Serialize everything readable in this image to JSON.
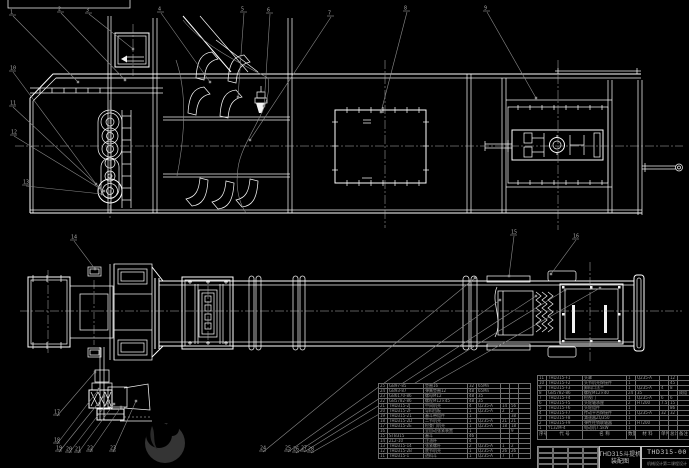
{
  "meta": {
    "drawing_type": "CAD assembly drawing, bucket elevator THD315",
    "bg_color": "#000000",
    "line_color": "#ffffff",
    "annotation_color": "#8a8a8a"
  },
  "title_block": {
    "title_line1": "THD315斗提机",
    "title_line2": "装配图",
    "drawing_number": "THD315-00",
    "organization": "机械设计第二课程设计"
  },
  "bom_header": [
    "序号",
    "代 号",
    "名 称",
    "数量",
    "材 料",
    "单件",
    "总计",
    "备注"
  ],
  "bom_left": {
    "rows": [
      {
        "no": "25",
        "code": "GB97-85",
        "name": "垫圈16",
        "qty": "32",
        "mat": "65Mn",
        "uw": "",
        "tw": "",
        "note": ""
      },
      {
        "no": "24",
        "code": "GB93-87",
        "name": "弹簧垫圈12",
        "qty": "48",
        "mat": "65Mn",
        "uw": "",
        "tw": "",
        "note": ""
      },
      {
        "no": "23",
        "code": "GB6170-86",
        "name": "螺母M12",
        "qty": "48",
        "mat": "35",
        "uw": "",
        "tw": "",
        "note": ""
      },
      {
        "no": "22",
        "code": "GB5782-86",
        "name": "螺栓M12×45",
        "qty": "48",
        "mat": "35",
        "uw": "",
        "tw": "",
        "note": ""
      },
      {
        "no": "21",
        "code": "THD315-2J",
        "name": "中间机壳",
        "qty": "4",
        "mat": "Q235-A",
        "uw": "14",
        "tw": "56",
        "note": ""
      },
      {
        "no": "20",
        "code": "THD315-2F",
        "name": "导料挡板",
        "qty": "1",
        "mat": "Q235-A",
        "uw": "2",
        "tw": "2",
        "note": ""
      },
      {
        "no": "19",
        "code": "THD315-21",
        "name": "畚斗带组件",
        "qty": "1",
        "mat": "",
        "uw": "",
        "tw": "38",
        "note": ""
      },
      {
        "no": "18",
        "code": "THD315-2D",
        "name": "二节机壳",
        "qty": "1",
        "mat": "Q235-A",
        "uw": "21",
        "tw": "21",
        "note": ""
      },
      {
        "no": "17",
        "code": "THD315-2E",
        "name": "检查门机壳",
        "qty": "1",
        "mat": "Q235-A",
        "uw": "18",
        "tw": "18",
        "note": ""
      },
      {
        "no": "16",
        "code": "",
        "name": "全自动张紧装置",
        "qty": "1",
        "mat": "",
        "uw": "",
        "tw": "9",
        "note": ""
      },
      {
        "no": "15",
        "code": "STB315",
        "name": "畚斗",
        "qty": "46",
        "mat": "",
        "uw": "",
        "tw": "",
        "note": ""
      },
      {
        "no": "14",
        "code": "ZL2-10",
        "name": "注油杯",
        "qty": "4",
        "mat": "",
        "uw": "",
        "tw": "",
        "note": ""
      },
      {
        "no": "13",
        "code": "THD315-14",
        "name": "张紧螺杆",
        "qty": "2",
        "mat": "Q235-A",
        "uw": "1",
        "tw": "2",
        "note": ""
      },
      {
        "no": "12",
        "code": "THD315-2B",
        "name": "底节机壳",
        "qty": "1",
        "mat": "Q235-A",
        "uw": "26",
        "tw": "26",
        "note": ""
      },
      {
        "no": "11",
        "code": "THD315-1",
        "name": "进料斗",
        "qty": "1",
        "mat": "Q235-A",
        "uw": "7",
        "tw": "7",
        "note": ""
      }
    ]
  },
  "bom_right": {
    "rows": [
      {
        "no": "11",
        "code": "THD315-F1",
        "name": "头罩",
        "qty": "1",
        "mat": "Q235-A",
        "uw": "",
        "tw": "12",
        "note": ""
      },
      {
        "no": "10",
        "code": "THD315-F2",
        "name": "头节机壳焊接件",
        "qty": "1",
        "mat": "",
        "uw": "",
        "tw": "45",
        "note": ""
      },
      {
        "no": "9",
        "code": "THD315-F3",
        "name": "卸料口法兰",
        "qty": "1",
        "mat": "Q235-A",
        "uw": "4",
        "tw": "8",
        "note": ""
      },
      {
        "no": "8",
        "code": "GB5782-86",
        "name": "螺栓M12×40",
        "qty": "24",
        "mat": "35",
        "uw": "",
        "tw": "",
        "note": "成组"
      },
      {
        "no": "7",
        "code": "THD315-F4",
        "name": "检视门",
        "qty": "1",
        "mat": "Q235-A",
        "uw": "6",
        "tw": "6",
        "note": ""
      },
      {
        "no": "6",
        "code": "THD315-F5",
        "name": "头轮轴承座",
        "qty": "2",
        "mat": "HT200",
        "uw": "7.5",
        "tw": "15",
        "note": ""
      },
      {
        "no": "5",
        "code": "THD315-F6",
        "name": "头轮组件",
        "qty": "1",
        "mat": "",
        "uw": "",
        "tw": "86",
        "note": ""
      },
      {
        "no": "4",
        "code": "THD315-F7",
        "name": "传动平台焊接件",
        "qty": "1",
        "mat": "Q235-A",
        "uw": "32",
        "tw": "32",
        "note": ""
      },
      {
        "no": "3",
        "code": "THD315-F8",
        "name": "减速器ZQ350",
        "qty": "1",
        "mat": "",
        "uw": "",
        "tw": "",
        "note": ""
      },
      {
        "no": "2",
        "code": "THD315-F9",
        "name": "弹性柱销联轴器",
        "qty": "1",
        "mat": "HT200",
        "uw": "",
        "tw": "",
        "note": ""
      },
      {
        "no": "1",
        "code": "Y132M-4",
        "name": "电动机7.5kW",
        "qty": "1",
        "mat": "",
        "uw": "",
        "tw": "",
        "note": ""
      }
    ]
  },
  "annotations": {
    "leaders": [
      {
        "label": "1",
        "bx": 12,
        "by": 12,
        "tx": 78,
        "ty": 82
      },
      {
        "label": "2",
        "bx": 60,
        "by": 9,
        "tx": 125,
        "ty": 80
      },
      {
        "label": "3",
        "bx": 88,
        "by": 10,
        "tx": 133,
        "ty": 49
      },
      {
        "label": "4",
        "bx": 160,
        "by": 9,
        "tx": 210,
        "ty": 82
      },
      {
        "label": "5",
        "bx": 243,
        "by": 9,
        "tx": 238,
        "ty": 97
      },
      {
        "label": "6",
        "bx": 269,
        "by": 10,
        "tx": 264,
        "ty": 106
      },
      {
        "label": "7",
        "bx": 330,
        "by": 13,
        "tx": 250,
        "ty": 140
      },
      {
        "label": "8",
        "bx": 406,
        "by": 8,
        "tx": 381,
        "ty": 112
      },
      {
        "label": "9",
        "bx": 486,
        "by": 8,
        "tx": 536,
        "ty": 98
      },
      {
        "label": "10",
        "bx": 12,
        "by": 68,
        "tx": 96,
        "ty": 184
      },
      {
        "label": "11",
        "bx": 12,
        "by": 103,
        "tx": 100,
        "ty": 188
      },
      {
        "label": "12",
        "bx": 13,
        "by": 132,
        "tx": 104,
        "ty": 191
      },
      {
        "label": "13",
        "bx": 25,
        "by": 182,
        "tx": 102,
        "ty": 194
      },
      {
        "label": "14",
        "bx": 73,
        "by": 237,
        "tx": 95,
        "ty": 269
      },
      {
        "label": "15",
        "bx": 513,
        "by": 232,
        "tx": 509,
        "ty": 276
      },
      {
        "label": "16",
        "bx": 575,
        "by": 236,
        "tx": 551,
        "ty": 274
      },
      {
        "label": "17",
        "bx": 56,
        "by": 412,
        "tx": 95,
        "ty": 372
      },
      {
        "label": "18",
        "bx": 56,
        "by": 440,
        "tx": 99,
        "ty": 389
      },
      {
        "label": "19",
        "bx": 58,
        "by": 448,
        "tx": 104,
        "ty": 396
      },
      {
        "label": "20",
        "bx": 68,
        "by": 449,
        "tx": 109,
        "ty": 401
      },
      {
        "label": "21",
        "bx": 77,
        "by": 449,
        "tx": 114,
        "ty": 404
      },
      {
        "label": "22",
        "bx": 89,
        "by": 448,
        "tx": 121,
        "ty": 407
      },
      {
        "label": "23",
        "bx": 112,
        "by": 448,
        "tx": 136,
        "ty": 401
      },
      {
        "label": "24",
        "bx": 262,
        "by": 448,
        "tx": 475,
        "ty": 278
      },
      {
        "label": "25",
        "bx": 287,
        "by": 448,
        "tx": 500,
        "ty": 300
      },
      {
        "label": "26",
        "bx": 295,
        "by": 449,
        "tx": 536,
        "ty": 296
      },
      {
        "label": "27",
        "bx": 303,
        "by": 448,
        "tx": 565,
        "ty": 290
      },
      {
        "label": "28",
        "bx": 310,
        "by": 449,
        "tx": 600,
        "ty": 288
      }
    ]
  }
}
